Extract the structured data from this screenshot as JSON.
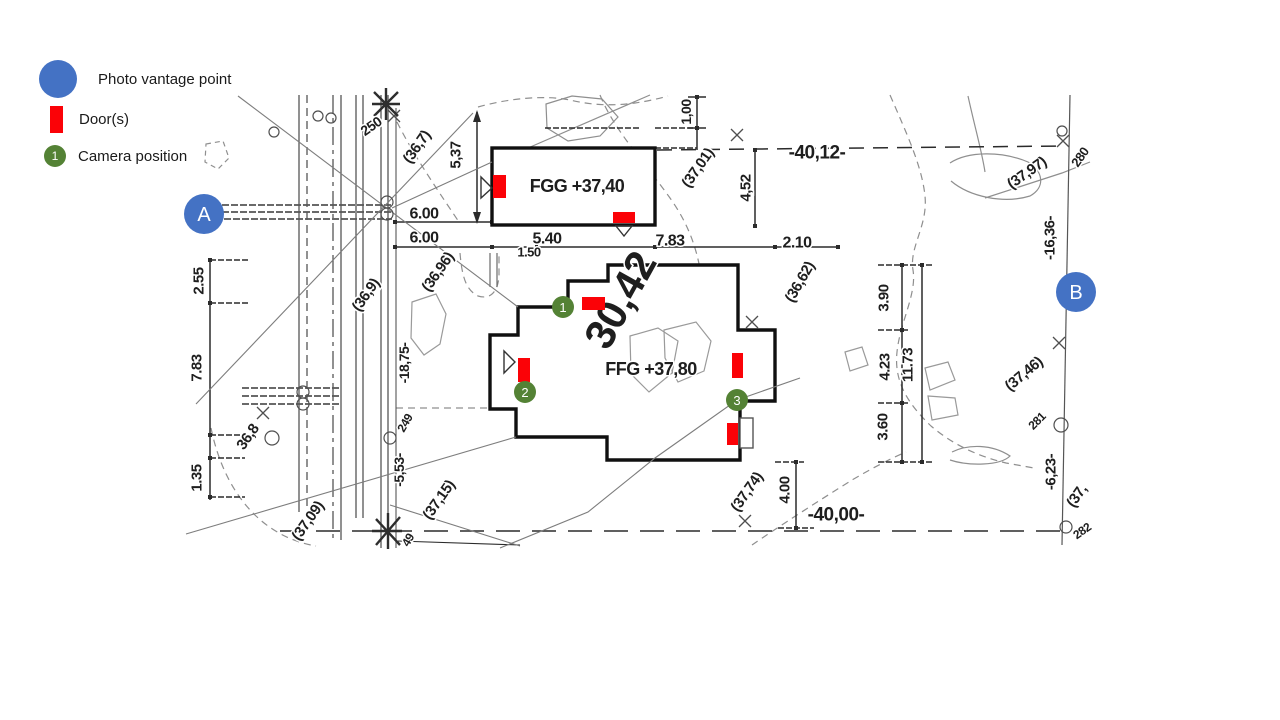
{
  "legend": {
    "items": [
      {
        "label": "Photo  vantage point",
        "icon": "photo-vantage-point"
      },
      {
        "label": "Door(s)",
        "icon": "door"
      },
      {
        "label": "Camera position",
        "icon": "camera-position",
        "badge": "1"
      }
    ]
  },
  "colors": {
    "vantage_blue": "#4472C4",
    "door_red": "#FB0207",
    "camera_green": "#548235",
    "ink": "#1e1e1e"
  },
  "plan": {
    "vantage_points": [
      {
        "label": "A",
        "x": 204,
        "y": 214
      },
      {
        "label": "B",
        "x": 1076,
        "y": 292
      }
    ],
    "cameras": [
      {
        "label": "1",
        "x": 563,
        "y": 307
      },
      {
        "label": "2",
        "x": 525,
        "y": 392
      },
      {
        "label": "3",
        "x": 737,
        "y": 400
      }
    ],
    "doors": [
      {
        "x": 493,
        "y": 175,
        "w": 13,
        "h": 23
      },
      {
        "x": 613,
        "y": 212,
        "w": 22,
        "h": 11
      },
      {
        "x": 582,
        "y": 297,
        "w": 23,
        "h": 13
      },
      {
        "x": 518,
        "y": 358,
        "w": 12,
        "h": 24
      },
      {
        "x": 732,
        "y": 353,
        "w": 11,
        "h": 25
      },
      {
        "x": 727,
        "y": 423,
        "w": 11,
        "h": 22
      }
    ],
    "labels": [
      {
        "t": "FGG +37,40",
        "x": 577,
        "y": 186,
        "r": 0,
        "s": 18,
        "n": "building-label-fgg"
      },
      {
        "t": "FFG +37,80",
        "x": 651,
        "y": 369,
        "r": 0,
        "s": 18,
        "n": "building-label-ffg"
      },
      {
        "t": "30,42",
        "x": 620,
        "y": 300,
        "r": -61,
        "s": 42,
        "n": "dimension-label-large"
      },
      {
        "t": "250",
        "x": 371,
        "y": 126,
        "r": -35,
        "s": 14
      },
      {
        "t": "(36,7)",
        "x": 417,
        "y": 147,
        "r": -55,
        "s": 15
      },
      {
        "t": "5,37",
        "x": 456,
        "y": 155,
        "r": -90,
        "s": 15
      },
      {
        "t": "6.00",
        "x": 424,
        "y": 214,
        "r": 0,
        "s": 16
      },
      {
        "t": "6.00",
        "x": 424,
        "y": 238,
        "r": 0,
        "s": 16
      },
      {
        "t": "5.40",
        "x": 547,
        "y": 239,
        "r": 0,
        "s": 16
      },
      {
        "t": "1.50",
        "x": 529,
        "y": 252,
        "r": 0,
        "s": 13
      },
      {
        "t": "7.83",
        "x": 670,
        "y": 241,
        "r": 0,
        "s": 16
      },
      {
        "t": "2.10",
        "x": 797,
        "y": 243,
        "r": 0,
        "s": 16
      },
      {
        "t": "-40,12-",
        "x": 817,
        "y": 153,
        "r": 0,
        "s": 19
      },
      {
        "t": "1,00",
        "x": 686,
        "y": 112,
        "r": -90,
        "s": 14
      },
      {
        "t": "(37,01)",
        "x": 698,
        "y": 168,
        "r": -55,
        "s": 15
      },
      {
        "t": "4,52",
        "x": 746,
        "y": 188,
        "r": -90,
        "s": 15
      },
      {
        "t": "(36,62)",
        "x": 800,
        "y": 282,
        "r": -60,
        "s": 15
      },
      {
        "t": "(36,9)",
        "x": 366,
        "y": 295,
        "r": -55,
        "s": 15
      },
      {
        "t": "(36,96)",
        "x": 438,
        "y": 272,
        "r": -55,
        "s": 15
      },
      {
        "t": "2.55",
        "x": 199,
        "y": 281,
        "r": -90,
        "s": 15
      },
      {
        "t": "7.83",
        "x": 197,
        "y": 368,
        "r": -90,
        "s": 15
      },
      {
        "t": "1.35",
        "x": 197,
        "y": 478,
        "r": -90,
        "s": 15
      },
      {
        "t": "36,8",
        "x": 248,
        "y": 437,
        "r": -55,
        "s": 15
      },
      {
        "t": "(37,09)",
        "x": 308,
        "y": 521,
        "r": -55,
        "s": 15
      },
      {
        "t": "(37,15)",
        "x": 439,
        "y": 500,
        "r": -55,
        "s": 15
      },
      {
        "t": "-18,75-",
        "x": 404,
        "y": 363,
        "r": -90,
        "s": 14
      },
      {
        "t": "249",
        "x": 405,
        "y": 423,
        "r": -60,
        "s": 12
      },
      {
        "t": "-5,53-",
        "x": 399,
        "y": 470,
        "r": -90,
        "s": 14
      },
      {
        "t": "49",
        "x": 408,
        "y": 540,
        "r": -60,
        "s": 12
      },
      {
        "t": "3.90",
        "x": 884,
        "y": 298,
        "r": -90,
        "s": 15
      },
      {
        "t": "4.23",
        "x": 885,
        "y": 367,
        "r": -90,
        "s": 15
      },
      {
        "t": "11.73",
        "x": 908,
        "y": 365,
        "r": -90,
        "s": 15
      },
      {
        "t": "3.60",
        "x": 883,
        "y": 427,
        "r": -90,
        "s": 15
      },
      {
        "t": "(37,74)",
        "x": 747,
        "y": 492,
        "r": -55,
        "s": 15
      },
      {
        "t": "4.00",
        "x": 785,
        "y": 490,
        "r": -90,
        "s": 15
      },
      {
        "t": "-40,00-",
        "x": 836,
        "y": 515,
        "r": 0,
        "s": 19
      },
      {
        "t": "(37,97)",
        "x": 1027,
        "y": 173,
        "r": -35,
        "s": 15
      },
      {
        "t": "280",
        "x": 1080,
        "y": 157,
        "r": -55,
        "s": 13
      },
      {
        "t": "-16,36-",
        "x": 1050,
        "y": 238,
        "r": -90,
        "s": 15
      },
      {
        "t": "(37,46)",
        "x": 1024,
        "y": 374,
        "r": -40,
        "s": 15
      },
      {
        "t": "281",
        "x": 1037,
        "y": 421,
        "r": -45,
        "s": 12
      },
      {
        "t": "-6,23-",
        "x": 1051,
        "y": 472,
        "r": -90,
        "s": 15
      },
      {
        "t": "(37,",
        "x": 1077,
        "y": 496,
        "r": -55,
        "s": 15
      },
      {
        "t": "282",
        "x": 1082,
        "y": 531,
        "r": -35,
        "s": 12
      }
    ]
  }
}
